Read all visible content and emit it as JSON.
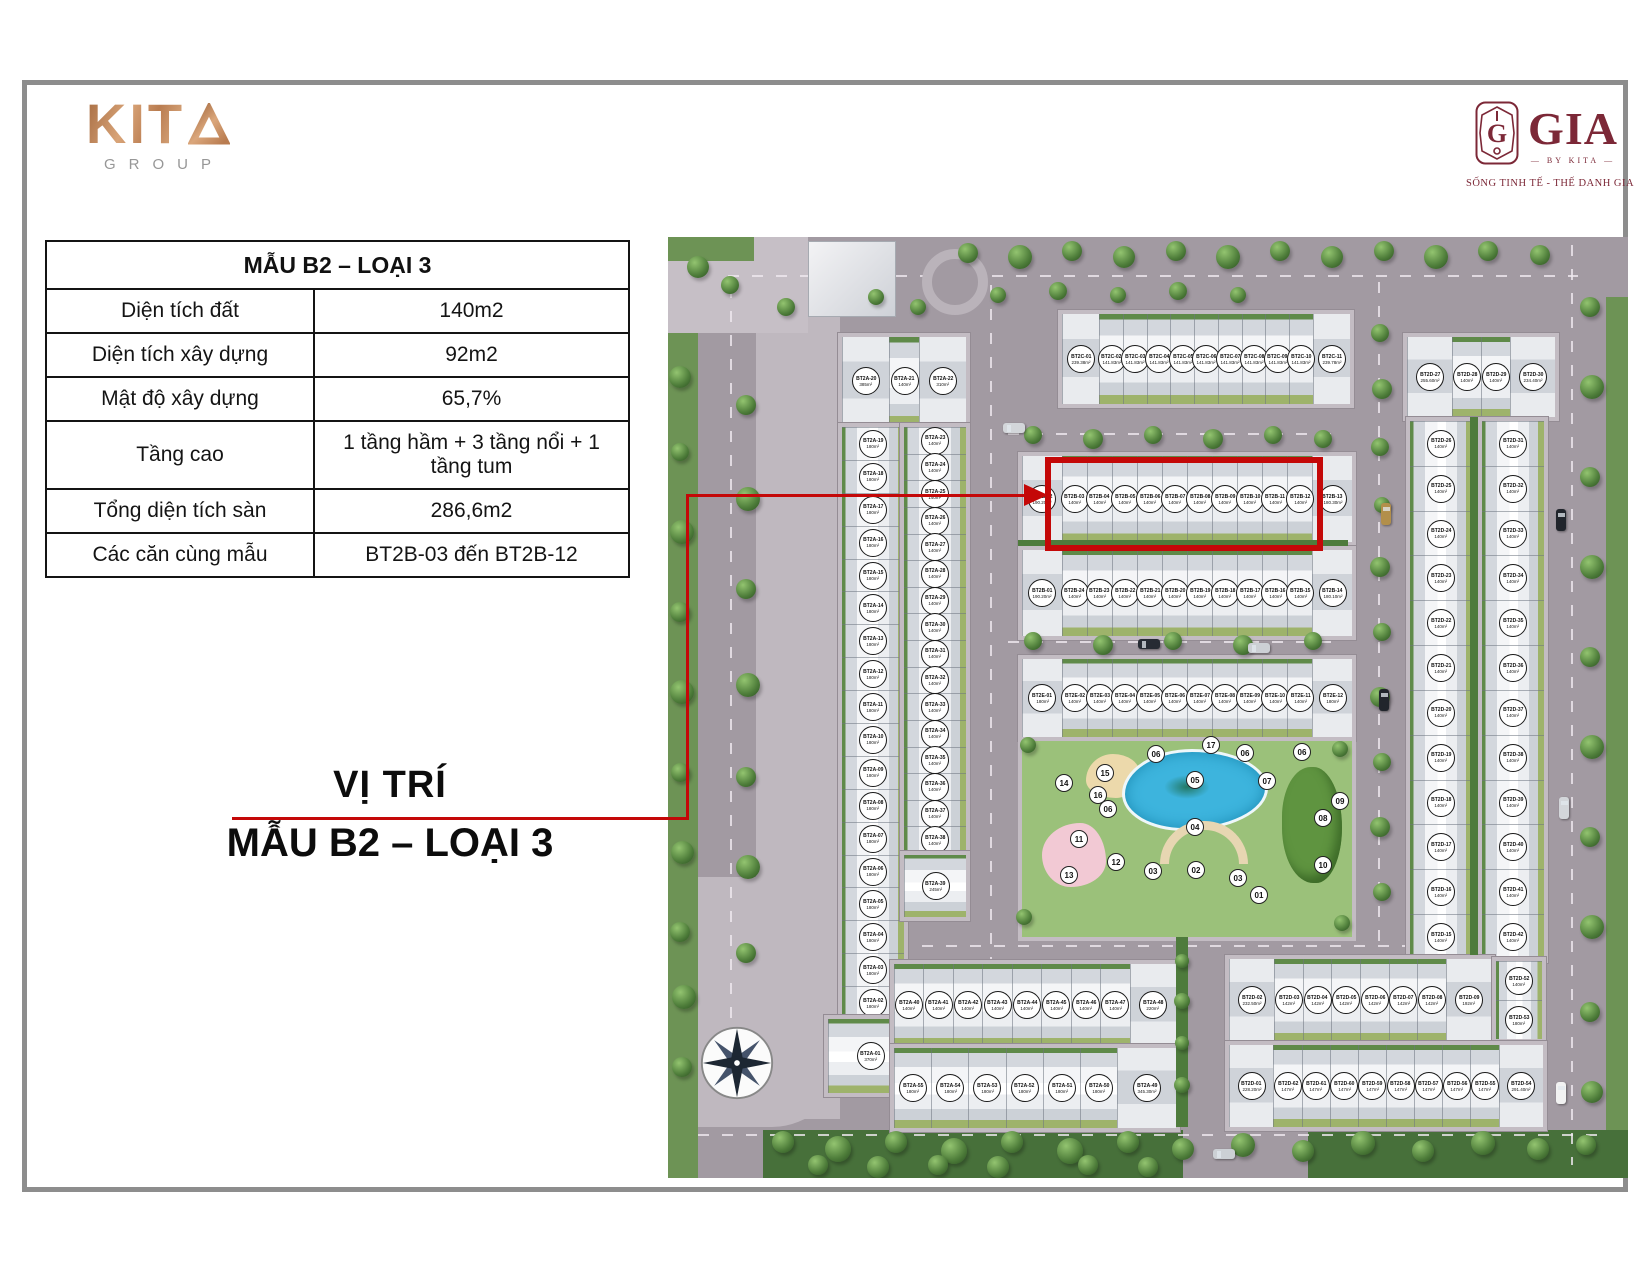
{
  "colors": {
    "accent_red": "#c40808",
    "kita_copper": "#c98c5f",
    "gia_maroon": "#7c2837"
  },
  "branding": {
    "kita": {
      "letters": "KIT",
      "group_label": "GROUP"
    },
    "gia": {
      "wordmark": "GIA",
      "by_label": "BY KITA",
      "tagline": "SỐNG TINH TẾ - THẾ DANH GIA"
    }
  },
  "spec_table": {
    "title": "MẪU B2 – LOẠI 3",
    "rows": [
      {
        "label": "Diện tích đất",
        "value": "140m2"
      },
      {
        "label": "Diện tích xây dựng",
        "value": "92m2"
      },
      {
        "label": "Mật độ xây dựng",
        "value": "65,7%"
      },
      {
        "label": "Tầng cao",
        "value": "1 tầng hầm + 3 tầng nổi + 1 tầng tum"
      },
      {
        "label": "Tổng diện tích sàn",
        "value": "286,6m2"
      },
      {
        "label": "Các căn cùng mẫu",
        "value": "BT2B-03 đến BT2B-12"
      }
    ]
  },
  "location_label": {
    "line1": "VỊ TRÍ",
    "line2": "MẪU B2 – LOẠI 3"
  },
  "map": {
    "highlighted_units": "BT2B-03 đến BT2B-12",
    "blocks": {
      "bt2a_top": {
        "units": [
          {
            "id": "BT2A-20",
            "area": "385m²"
          },
          {
            "id": "BT2A-21",
            "area": "140m²"
          },
          {
            "id": "BT2A-22",
            "area": "310m²"
          }
        ]
      },
      "bt2a_left_col": {
        "units": [
          {
            "id": "BT2A-19",
            "area": "180m²"
          },
          {
            "id": "BT2A-18",
            "area": "180m²"
          },
          {
            "id": "BT2A-17",
            "area": "180m²"
          },
          {
            "id": "BT2A-16",
            "area": "180m²"
          },
          {
            "id": "BT2A-15",
            "area": "180m²"
          },
          {
            "id": "BT2A-14",
            "area": "180m²"
          },
          {
            "id": "BT2A-13",
            "area": "180m²"
          },
          {
            "id": "BT2A-12",
            "area": "180m²"
          },
          {
            "id": "BT2A-11",
            "area": "180m²"
          },
          {
            "id": "BT2A-10",
            "area": "180m²"
          },
          {
            "id": "BT2A-09",
            "area": "180m²"
          },
          {
            "id": "BT2A-08",
            "area": "180m²"
          },
          {
            "id": "BT2A-07",
            "area": "180m²"
          },
          {
            "id": "BT2A-06",
            "area": "180m²"
          },
          {
            "id": "BT2A-05",
            "area": "180m²"
          },
          {
            "id": "BT2A-04",
            "area": "180m²"
          },
          {
            "id": "BT2A-03",
            "area": "180m²"
          },
          {
            "id": "BT2A-02",
            "area": "180m²"
          }
        ]
      },
      "bt2a_right_col": {
        "units": [
          {
            "id": "BT2A-23",
            "area": "140m²"
          },
          {
            "id": "BT2A-24",
            "area": "140m²"
          },
          {
            "id": "BT2A-25",
            "area": "140m²"
          },
          {
            "id": "BT2A-26",
            "area": "140m²"
          },
          {
            "id": "BT2A-27",
            "area": "140m²"
          },
          {
            "id": "BT2A-28",
            "area": "140m²"
          },
          {
            "id": "BT2A-29",
            "area": "140m²"
          },
          {
            "id": "BT2A-30",
            "area": "140m²"
          },
          {
            "id": "BT2A-31",
            "area": "140m²"
          },
          {
            "id": "BT2A-32",
            "area": "140m²"
          },
          {
            "id": "BT2A-33",
            "area": "140m²"
          },
          {
            "id": "BT2A-34",
            "area": "140m²"
          },
          {
            "id": "BT2A-35",
            "area": "140m²"
          },
          {
            "id": "BT2A-36",
            "area": "140m²"
          },
          {
            "id": "BT2A-37",
            "area": "140m²"
          },
          {
            "id": "BT2A-38",
            "area": "140m²"
          }
        ]
      },
      "bt2a_corner_39": {
        "units": [
          {
            "id": "BT2A-39",
            "area": "245m²"
          }
        ]
      },
      "bt2a_corner_01": {
        "units": [
          {
            "id": "BT2A-01",
            "area": "370m²"
          }
        ]
      },
      "bt2c_row": {
        "units": [
          {
            "id": "BT2C-01",
            "area": "239.38m²"
          },
          {
            "id": "BT2C-02",
            "area": "141.83m²"
          },
          {
            "id": "BT2C-03",
            "area": "141.83m²"
          },
          {
            "id": "BT2C-04",
            "area": "141.83m²"
          },
          {
            "id": "BT2C-05",
            "area": "141.83m²"
          },
          {
            "id": "BT2C-06",
            "area": "141.83m²"
          },
          {
            "id": "BT2C-07",
            "area": "141.83m²"
          },
          {
            "id": "BT2C-08",
            "area": "141.83m²"
          },
          {
            "id": "BT2C-09",
            "area": "141.83m²"
          },
          {
            "id": "BT2C-10",
            "area": "141.83m²"
          },
          {
            "id": "BT2C-11",
            "area": "239.78m²"
          }
        ]
      },
      "bt2b_north": {
        "units": [
          {
            "id": "BT2B-02",
            "area": "190.20m²"
          },
          {
            "id": "BT2B-03",
            "area": "140m²"
          },
          {
            "id": "BT2B-04",
            "area": "140m²"
          },
          {
            "id": "BT2B-05",
            "area": "140m²"
          },
          {
            "id": "BT2B-06",
            "area": "140m²"
          },
          {
            "id": "BT2B-07",
            "area": "140m²"
          },
          {
            "id": "BT2B-08",
            "area": "140m²"
          },
          {
            "id": "BT2B-09",
            "area": "140m²"
          },
          {
            "id": "BT2B-10",
            "area": "140m²"
          },
          {
            "id": "BT2B-11",
            "area": "140m²"
          },
          {
            "id": "BT2B-12",
            "area": "140m²"
          },
          {
            "id": "BT2B-13",
            "area": "180.30m²"
          }
        ]
      },
      "bt2b_south": {
        "units": [
          {
            "id": "BT2B-01",
            "area": "190.20m²"
          },
          {
            "id": "BT2B-24",
            "area": "140m²"
          },
          {
            "id": "BT2B-23",
            "area": "140m²"
          },
          {
            "id": "BT2B-22",
            "area": "140m²"
          },
          {
            "id": "BT2B-21",
            "area": "140m²"
          },
          {
            "id": "BT2B-20",
            "area": "140m²"
          },
          {
            "id": "BT2B-19",
            "area": "140m²"
          },
          {
            "id": "BT2B-18",
            "area": "140m²"
          },
          {
            "id": "BT2B-17",
            "area": "140m²"
          },
          {
            "id": "BT2B-16",
            "area": "140m²"
          },
          {
            "id": "BT2B-15",
            "area": "140m²"
          },
          {
            "id": "BT2B-14",
            "area": "180.10m²"
          }
        ]
      },
      "bt2e_row": {
        "units": [
          {
            "id": "BT2E-01",
            "area": "180m²"
          },
          {
            "id": "BT2E-02",
            "area": "140m²"
          },
          {
            "id": "BT2E-03",
            "area": "140m²"
          },
          {
            "id": "BT2E-04",
            "area": "140m²"
          },
          {
            "id": "BT2E-05",
            "area": "140m²"
          },
          {
            "id": "BT2E-06",
            "area": "140m²"
          },
          {
            "id": "BT2E-07",
            "area": "140m²"
          },
          {
            "id": "BT2E-08",
            "area": "140m²"
          },
          {
            "id": "BT2E-09",
            "area": "140m²"
          },
          {
            "id": "BT2E-10",
            "area": "140m²"
          },
          {
            "id": "BT2E-11",
            "area": "140m²"
          },
          {
            "id": "BT2E-12",
            "area": "180m²"
          }
        ]
      },
      "bt2d_top": {
        "units": [
          {
            "id": "BT2D-27",
            "area": "255.60m²"
          },
          {
            "id": "BT2D-28",
            "area": "140m²"
          },
          {
            "id": "BT2D-29",
            "area": "140m²"
          },
          {
            "id": "BT2D-30",
            "area": "234.40m²"
          }
        ]
      },
      "bt2d_left_col": {
        "units": [
          {
            "id": "BT2D-26",
            "area": "140m²"
          },
          {
            "id": "BT2D-25",
            "area": "140m²"
          },
          {
            "id": "BT2D-24",
            "area": "140m²"
          },
          {
            "id": "BT2D-23",
            "area": "140m²"
          },
          {
            "id": "BT2D-22",
            "area": "140m²"
          },
          {
            "id": "BT2D-21",
            "area": "140m²"
          },
          {
            "id": "BT2D-20",
            "area": "140m²"
          },
          {
            "id": "BT2D-19",
            "area": "140m²"
          },
          {
            "id": "BT2D-18",
            "area": "140m²"
          },
          {
            "id": "BT2D-17",
            "area": "140m²"
          },
          {
            "id": "BT2D-16",
            "area": "140m²"
          },
          {
            "id": "BT2D-15",
            "area": "140m²"
          }
        ]
      },
      "bt2d_right_col": {
        "units": [
          {
            "id": "BT2D-31",
            "area": "140m²"
          },
          {
            "id": "BT2D-32",
            "area": "140m²"
          },
          {
            "id": "BT2D-33",
            "area": "140m²"
          },
          {
            "id": "BT2D-34",
            "area": "140m²"
          },
          {
            "id": "BT2D-35",
            "area": "140m²"
          },
          {
            "id": "BT2D-36",
            "area": "140m²"
          },
          {
            "id": "BT2D-37",
            "area": "140m²"
          },
          {
            "id": "BT2D-38",
            "area": "140m²"
          },
          {
            "id": "BT2D-39",
            "area": "140m²"
          },
          {
            "id": "BT2D-40",
            "area": "140m²"
          },
          {
            "id": "BT2D-41",
            "area": "140m²"
          },
          {
            "id": "BT2D-42",
            "area": "140m²"
          }
        ]
      },
      "bt2a_bl_north": {
        "units": [
          {
            "id": "BT2A-40",
            "area": "140m²"
          },
          {
            "id": "BT2A-41",
            "area": "140m²"
          },
          {
            "id": "BT2A-42",
            "area": "140m²"
          },
          {
            "id": "BT2A-43",
            "area": "140m²"
          },
          {
            "id": "BT2A-44",
            "area": "140m²"
          },
          {
            "id": "BT2A-45",
            "area": "140m²"
          },
          {
            "id": "BT2A-46",
            "area": "140m²"
          },
          {
            "id": "BT2A-47",
            "area": "140m²"
          },
          {
            "id": "BT2A-48",
            "area": "220m²"
          }
        ]
      },
      "bt2a_bl_south": {
        "units": [
          {
            "id": "BT2A-55",
            "area": "180m²"
          },
          {
            "id": "BT2A-54",
            "area": "180m²"
          },
          {
            "id": "BT2A-53",
            "area": "180m²"
          },
          {
            "id": "BT2A-52",
            "area": "180m²"
          },
          {
            "id": "BT2A-51",
            "area": "180m²"
          },
          {
            "id": "BT2A-50",
            "area": "180m²"
          },
          {
            "id": "BT2A-49",
            "area": "345.30m²"
          }
        ]
      },
      "bt2d_br_north": {
        "units": [
          {
            "id": "BT2D-02",
            "area": "232.50m²"
          },
          {
            "id": "BT2D-03",
            "area": "142m²"
          },
          {
            "id": "BT2D-04",
            "area": "142m²"
          },
          {
            "id": "BT2D-05",
            "area": "142m²"
          },
          {
            "id": "BT2D-06",
            "area": "142m²"
          },
          {
            "id": "BT2D-07",
            "area": "142m²"
          },
          {
            "id": "BT2D-08",
            "area": "142m²"
          },
          {
            "id": "BT2D-09",
            "area": "192m²"
          }
        ]
      },
      "bt2d_br_stack": {
        "units": [
          {
            "id": "BT2D-52",
            "area": "140m²"
          },
          {
            "id": "BT2D-53",
            "area": "180m²"
          }
        ]
      },
      "bt2d_br_south": {
        "units": [
          {
            "id": "BT2D-01",
            "area": "228.20m²"
          },
          {
            "id": "BT2D-62",
            "area": "147m²"
          },
          {
            "id": "BT2D-61",
            "area": "147m²"
          },
          {
            "id": "BT2D-60",
            "area": "147m²"
          },
          {
            "id": "BT2D-59",
            "area": "147m²"
          },
          {
            "id": "BT2D-58",
            "area": "147m²"
          },
          {
            "id": "BT2D-57",
            "area": "147m²"
          },
          {
            "id": "BT2D-56",
            "area": "147m²"
          },
          {
            "id": "BT2D-55",
            "area": "147m²"
          },
          {
            "id": "BT2D-54",
            "area": "291.40m²"
          }
        ]
      }
    },
    "amenities": [
      {
        "n": "06",
        "x": 134,
        "y": 13
      },
      {
        "n": "17",
        "x": 189,
        "y": 4
      },
      {
        "n": "06",
        "x": 223,
        "y": 12
      },
      {
        "n": "06",
        "x": 280,
        "y": 11
      },
      {
        "n": "15",
        "x": 83,
        "y": 32
      },
      {
        "n": "05",
        "x": 173,
        "y": 39
      },
      {
        "n": "07",
        "x": 245,
        "y": 40
      },
      {
        "n": "14",
        "x": 42,
        "y": 42
      },
      {
        "n": "16",
        "x": 76,
        "y": 54
      },
      {
        "n": "06",
        "x": 86,
        "y": 68
      },
      {
        "n": "09",
        "x": 318,
        "y": 60
      },
      {
        "n": "08",
        "x": 301,
        "y": 77
      },
      {
        "n": "04",
        "x": 173,
        "y": 86
      },
      {
        "n": "11",
        "x": 57,
        "y": 98
      },
      {
        "n": "12",
        "x": 94,
        "y": 121
      },
      {
        "n": "13",
        "x": 47,
        "y": 134
      },
      {
        "n": "03",
        "x": 131,
        "y": 130
      },
      {
        "n": "02",
        "x": 174,
        "y": 129
      },
      {
        "n": "03",
        "x": 216,
        "y": 137
      },
      {
        "n": "10",
        "x": 301,
        "y": 124
      },
      {
        "n": "01",
        "x": 237,
        "y": 154
      }
    ]
  }
}
